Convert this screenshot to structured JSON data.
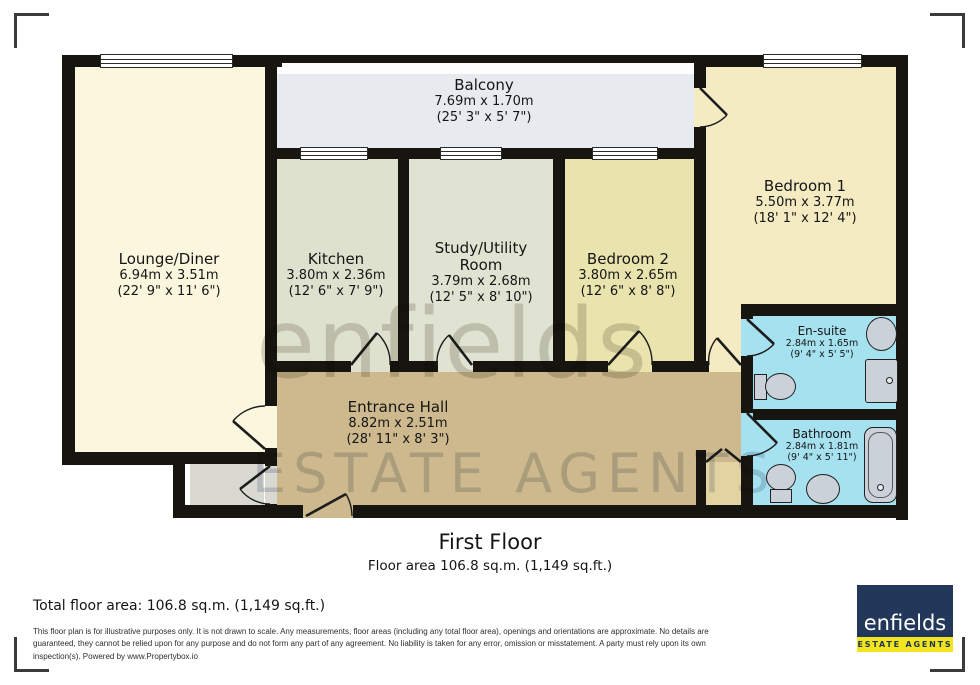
{
  "plan": {
    "rooms": {
      "balcony": {
        "name": "Balcony",
        "dim_m": "7.69m x 1.70m",
        "dim_i": "(25' 3\" x 5' 7\")"
      },
      "lounge": {
        "name": "Lounge/Diner",
        "dim_m": "6.94m x 3.51m",
        "dim_i": "(22' 9\" x 11' 6\")"
      },
      "kitchen": {
        "name": "Kitchen",
        "dim_m": "3.80m x 2.36m",
        "dim_i": "(12' 6\" x 7' 9\")"
      },
      "study": {
        "name": "Study/Utility Room",
        "dim_m": "3.79m x 2.68m",
        "dim_i": "(12' 5\" x 8' 10\")"
      },
      "bedroom2": {
        "name": "Bedroom 2",
        "dim_m": "3.80m x 2.65m",
        "dim_i": "(12' 6\" x 8' 8\")"
      },
      "bedroom1": {
        "name": "Bedroom 1",
        "dim_m": "5.50m x 3.77m",
        "dim_i": "(18' 1\" x 12' 4\")"
      },
      "hall": {
        "name": "Entrance Hall",
        "dim_m": "8.82m x 2.51m",
        "dim_i": "(28' 11\" x 8' 3\")"
      },
      "ensuite": {
        "name": "En-suite",
        "dim_m": "2.84m x 1.65m",
        "dim_i": "(9' 4\" x 5' 5\")"
      },
      "bathroom": {
        "name": "Bathroom",
        "dim_m": "2.84m x 1.81m",
        "dim_i": "(9' 4\" x 5' 11\")"
      }
    },
    "watermark": {
      "line1": "enfields",
      "line2": "ESTATE AGENTS"
    }
  },
  "caption": {
    "floor": "First Floor",
    "area": "Floor area 106.8 sq.m. (1,149 sq.ft.)"
  },
  "footer": {
    "total": "Total floor area: 106.8 sq.m. (1,149 sq.ft.)",
    "disclaimer": [
      "This floor plan is for illustrative purposes only. It is not drawn to scale. Any measurements, floor areas (including any total floor area), openings and orientations are approximate. No details are",
      "guaranteed, they cannot be relied upon for any purpose and do not form any part of any agreement. No liability is taken for any error, omission or misstatement. A party must rely upon its own",
      "inspection(s). Powered by www.Propertybox.io"
    ]
  },
  "logo": {
    "brand": "enfields",
    "tagline": "ESTATE AGENTS"
  },
  "colors": {
    "wall": "#17150f",
    "lounge": "#FBF6DE",
    "kitchen": "#DFE1CF",
    "study": "#E1E3D2",
    "bedroom2": "#E9E3AE",
    "bedroom1": "#F4EBC2",
    "hall": "#CDB98D",
    "balcony": "#E7EBF0",
    "wet_rooms": "#A6E1F0",
    "store": "#D9D9D2",
    "logo_navy": "#22375a",
    "logo_yellow": "#f2e41f"
  }
}
